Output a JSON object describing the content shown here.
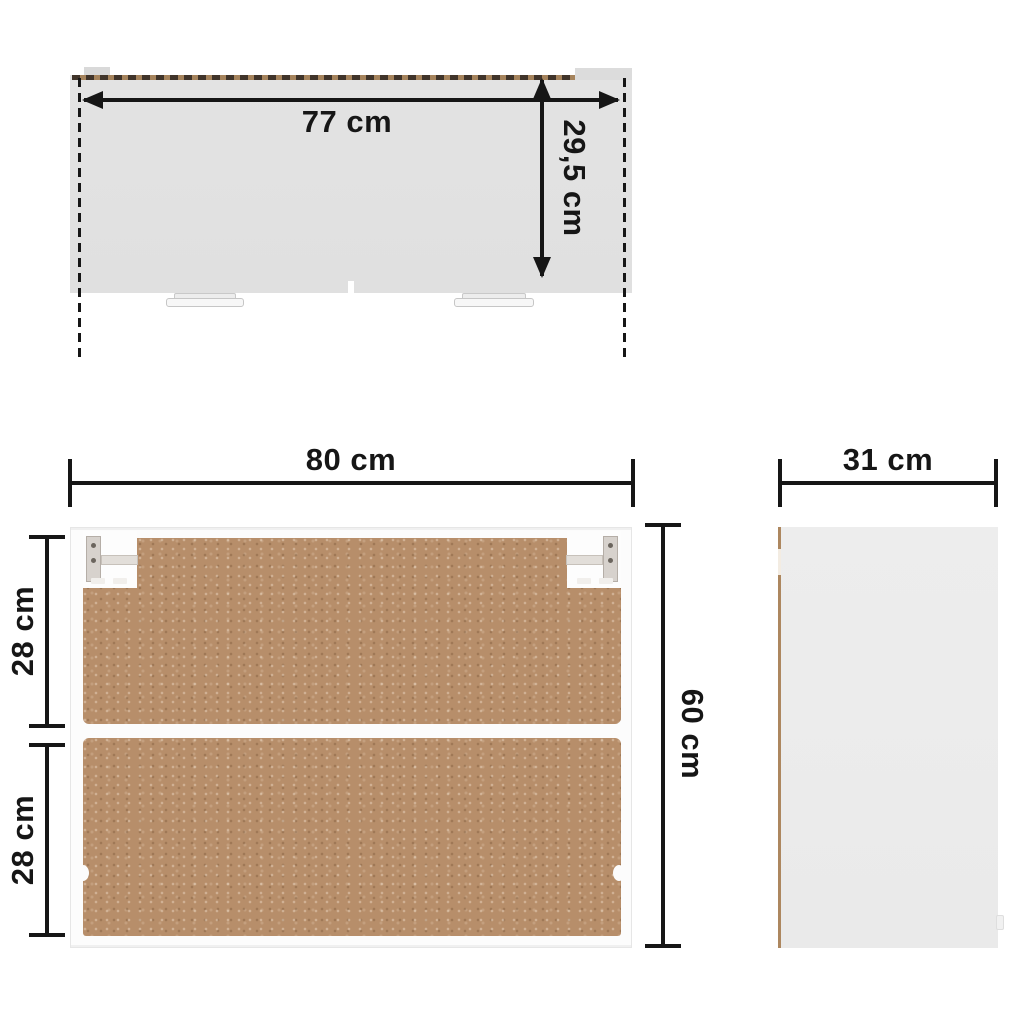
{
  "diagram": {
    "name": "wall-cabinet-dimension-diagram",
    "top_view": {
      "width": "77 cm",
      "depth": "29,5 cm"
    },
    "front_view": {
      "width": "80 cm",
      "height": "60 cm",
      "upper_compartment": "28 cm",
      "lower_compartment": "28 cm"
    },
    "side_view": {
      "depth": "31 cm"
    }
  },
  "colors": {
    "ink": "#161616",
    "top-fill": "#e3e3e3",
    "side-fill": "#ececec",
    "panel": "#b78e6a",
    "edge-brown": "#a5835c",
    "edge-dark": "#40342a",
    "frame": "#fcfcfc"
  }
}
